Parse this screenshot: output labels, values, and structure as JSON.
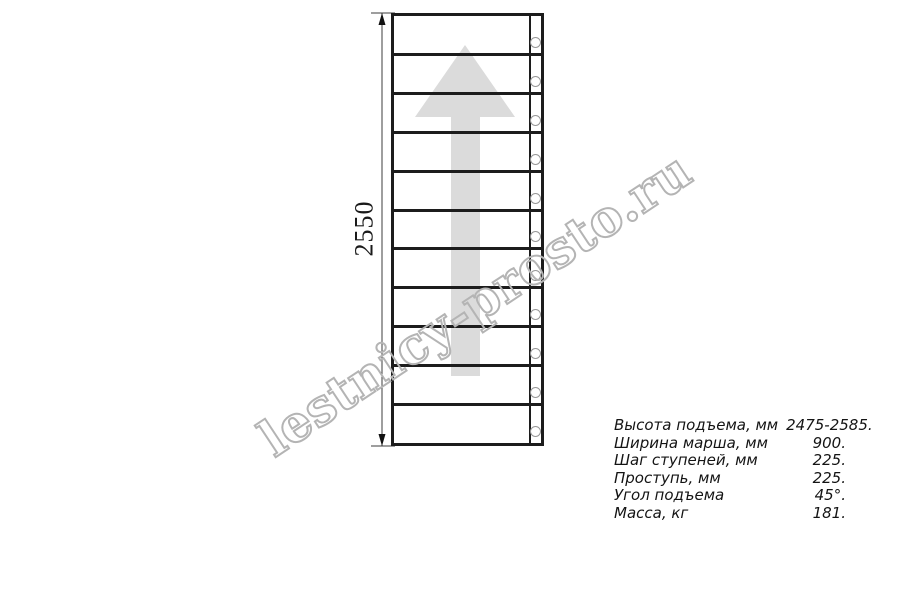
{
  "page": {
    "background": "#ffffff",
    "line_color": "#1c1c1c"
  },
  "drawing": {
    "type": "straight-staircase-plan-top-view",
    "dimension": {
      "label": "2550"
    },
    "steps": {
      "count": 11
    },
    "bolts": {
      "count": 11,
      "stroke_color": "#979797"
    },
    "direction_arrow": {
      "meaning": "direction-of-ascent-up",
      "color": "#dbdbdb"
    }
  },
  "watermark": {
    "text": "lestnicy-prosto.ru",
    "outline_color": "#b4b4b4"
  },
  "specs": {
    "rows": [
      {
        "label": "Высота подъема, мм",
        "value": "2475-2585."
      },
      {
        "label": "Ширина марша, мм",
        "value": "900."
      },
      {
        "label": "Шаг ступеней, мм",
        "value": "225."
      },
      {
        "label": "Проступь, мм",
        "value": "225."
      },
      {
        "label": "Угол подъема",
        "value": "45°."
      },
      {
        "label": "Масса, кг",
        "value": "181."
      }
    ]
  }
}
